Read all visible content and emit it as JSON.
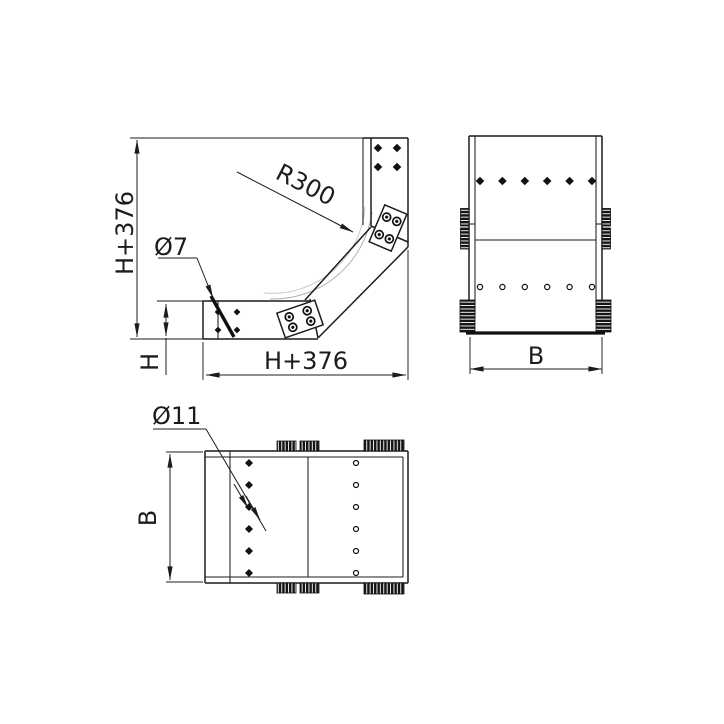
{
  "side_view": {
    "overall_height": "H+376",
    "overall_width": "H+376",
    "tray_height": "H",
    "bend_radius": "R300",
    "side_slot_diameter": "Ø7"
  },
  "front_view": {
    "width": "B"
  },
  "plan_view": {
    "width": "B",
    "bottom_hole_diameter": "Ø11"
  },
  "colors": {
    "line": "#1c1c1c",
    "faint_arc": "#b3b3b3",
    "faint_arc2": "#c9c9c9",
    "background": "#ffffff"
  }
}
